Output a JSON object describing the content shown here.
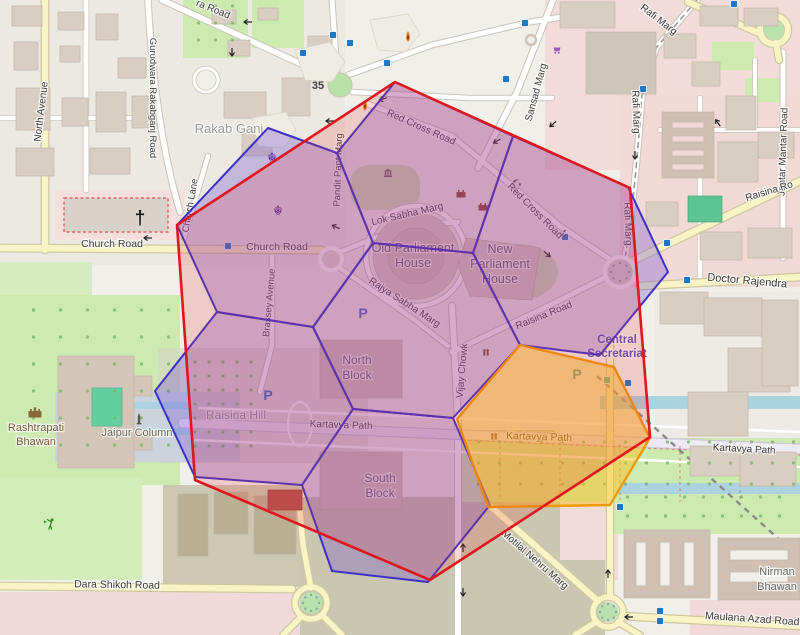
{
  "overlays": {
    "red_hexagon": {
      "stroke": "#e0161f",
      "fill": "rgba(230,60,60,0.20)",
      "stroke_width": 2.6,
      "points": [
        [
          395,
          82
        ],
        [
          630,
          188
        ],
        [
          650,
          437
        ],
        [
          430,
          580
        ],
        [
          195,
          480
        ],
        [
          177,
          225
        ]
      ]
    },
    "blue_hexagons": {
      "stroke": "#3c30c8",
      "fill": "rgba(105,70,205,0.30)",
      "stroke_width": 2,
      "cells": [
        [
          [
            373,
            243
          ],
          [
            337,
            153
          ],
          [
            395,
            82
          ],
          [
            513,
            136
          ],
          [
            473,
            253
          ]
        ],
        [
          [
            473,
            253
          ],
          [
            513,
            136
          ],
          [
            628,
            187
          ],
          [
            668,
            272
          ],
          [
            600,
            355
          ],
          [
            520,
            345
          ]
        ],
        [
          [
            373,
            243
          ],
          [
            473,
            253
          ],
          [
            520,
            345
          ],
          [
            453,
            418
          ],
          [
            353,
            409
          ],
          [
            313,
            327
          ]
        ],
        [
          [
            337,
            153
          ],
          [
            268,
            128
          ],
          [
            177,
            225
          ],
          [
            217,
            312
          ],
          [
            313,
            327
          ],
          [
            373,
            243
          ]
        ],
        [
          [
            313,
            327
          ],
          [
            217,
            312
          ],
          [
            155,
            391
          ],
          [
            195,
            477
          ],
          [
            302,
            485
          ],
          [
            353,
            409
          ]
        ],
        [
          [
            353,
            409
          ],
          [
            302,
            485
          ],
          [
            332,
            571
          ],
          [
            428,
            582
          ],
          [
            490,
            505
          ],
          [
            453,
            418
          ]
        ]
      ]
    },
    "yellow_hexagon": {
      "stroke": "#ee9a00",
      "fill": "rgba(250,192,35,0.50)",
      "stroke_width": 2.4,
      "points": [
        [
          520,
          345
        ],
        [
          614,
          367
        ],
        [
          650,
          438
        ],
        [
          610,
          505
        ],
        [
          488,
          507
        ],
        [
          457,
          419
        ]
      ]
    }
  },
  "labels": [
    {
      "name": "road-label",
      "t": "North Avenue",
      "x": 44,
      "y": 112,
      "r": -83,
      "fs": 10
    },
    {
      "name": "road-label",
      "t": "Gurudwara Rakabganj Road",
      "x": 150,
      "y": 98,
      "r": 90,
      "fs": 9.5
    },
    {
      "name": "road-label",
      "t": "ra Road",
      "x": 212,
      "y": 12,
      "r": 22,
      "fs": 10
    },
    {
      "name": "place-label",
      "t": "Rakab Ganj",
      "x": 229,
      "y": 133,
      "r": 0,
      "fs": 13,
      "c": "#9c9c9c"
    },
    {
      "name": "road-label",
      "t": "Rafi Marg",
      "x": 657,
      "y": 22,
      "r": 38,
      "fs": 10
    },
    {
      "name": "road-label",
      "t": "Rafi Marg",
      "x": 633,
      "y": 112,
      "r": 88,
      "fs": 10
    },
    {
      "name": "road-label",
      "t": "Rafi Marg",
      "x": 625,
      "y": 224,
      "r": 88,
      "fs": 10
    },
    {
      "name": "road-label",
      "t": "Sansad Marg",
      "x": 539,
      "y": 93,
      "r": -75,
      "fs": 10
    },
    {
      "name": "road-label",
      "t": "Jantar Mantar Road",
      "x": 786,
      "y": 152,
      "r": -88,
      "fs": 10
    },
    {
      "name": "road-label",
      "t": "Raisina Ro",
      "x": 770,
      "y": 194,
      "r": -17,
      "fs": 10
    },
    {
      "name": "road-label",
      "t": "Doctor Rajendra",
      "x": 747,
      "y": 284,
      "r": 5,
      "fs": 11
    },
    {
      "name": "road-label",
      "t": "Red Cross Road",
      "x": 420,
      "y": 130,
      "r": 24,
      "fs": 10
    },
    {
      "name": "road-label",
      "t": "Red Cross Road",
      "x": 533,
      "y": 213,
      "r": 45,
      "fs": 10
    },
    {
      "name": "road-label",
      "t": "Church Road",
      "x": 112,
      "y": 247,
      "r": 0,
      "fs": 10.5
    },
    {
      "name": "road-label",
      "t": "Church Road",
      "x": 277,
      "y": 250,
      "r": 0,
      "fs": 10.5
    },
    {
      "name": "road-label",
      "t": "Church Lane",
      "x": 193,
      "y": 206,
      "r": -80,
      "fs": 9.5
    },
    {
      "name": "road-label",
      "t": "Pandit Pant Marg",
      "x": 341,
      "y": 170,
      "r": -88,
      "fs": 9.5
    },
    {
      "name": "road-label",
      "t": "Brassey Avenue",
      "x": 272,
      "y": 303,
      "r": -85,
      "fs": 9.5
    },
    {
      "name": "road-label",
      "t": "Lok Sabha Marg",
      "x": 408,
      "y": 217,
      "r": -13,
      "fs": 10
    },
    {
      "name": "road-label",
      "t": "Rajya Sabha Marg",
      "x": 403,
      "y": 305,
      "r": 33,
      "fs": 10
    },
    {
      "name": "road-label",
      "t": "Raisina Road",
      "x": 545,
      "y": 318,
      "r": -22,
      "fs": 10
    },
    {
      "name": "place-label",
      "t": "Raisina Hill",
      "x": 236,
      "y": 419,
      "r": 0,
      "fs": 12,
      "c": "#8b8b96"
    },
    {
      "name": "building-label",
      "t": "Old Parliament",
      "x": 413,
      "y": 252,
      "r": 0,
      "fs": 12.5,
      "c": "#5d5763"
    },
    {
      "name": "building-label",
      "t": "House",
      "x": 413,
      "y": 267,
      "r": 0,
      "fs": 12.5,
      "c": "#5d5763"
    },
    {
      "name": "building-label",
      "t": "New",
      "x": 500,
      "y": 253,
      "r": 0,
      "fs": 12.5,
      "c": "#5d5763"
    },
    {
      "name": "building-label",
      "t": "Parliament",
      "x": 500,
      "y": 268,
      "r": 0,
      "fs": 12.5,
      "c": "#5d5763"
    },
    {
      "name": "building-label",
      "t": "House",
      "x": 500,
      "y": 283,
      "r": 0,
      "fs": 12.5,
      "c": "#5d5763"
    },
    {
      "name": "building-label",
      "t": "North",
      "x": 357,
      "y": 364,
      "r": 0,
      "fs": 12,
      "c": "#5d5763"
    },
    {
      "name": "building-label",
      "t": "Block",
      "x": 357,
      "y": 379,
      "r": 0,
      "fs": 12,
      "c": "#5d5763"
    },
    {
      "name": "building-label",
      "t": "South",
      "x": 380,
      "y": 482,
      "r": 0,
      "fs": 12,
      "c": "#5d5763"
    },
    {
      "name": "building-label",
      "t": "Block",
      "x": 380,
      "y": 497,
      "r": 0,
      "fs": 12,
      "c": "#5d5763"
    },
    {
      "name": "road-label",
      "t": "Kartavya Path",
      "x": 341,
      "y": 428,
      "r": 2,
      "fs": 10
    },
    {
      "name": "road-label",
      "t": "Kartavya Path",
      "x": 539,
      "y": 440,
      "r": 2,
      "fs": 10.5,
      "c": "#4a3a14"
    },
    {
      "name": "road-label",
      "t": "Kartavya Path",
      "x": 744,
      "y": 452,
      "r": 3,
      "fs": 10
    },
    {
      "name": "road-label",
      "t": "Vijay Chowk",
      "x": 465,
      "y": 371,
      "r": -85,
      "fs": 10
    },
    {
      "name": "amenity-label",
      "t": "Rashtrapati",
      "x": 36,
      "y": 431,
      "r": 0,
      "fs": 11,
      "c": "#7a5b38"
    },
    {
      "name": "amenity-label",
      "t": "Bhawan",
      "x": 36,
      "y": 445,
      "r": 0,
      "fs": 11,
      "c": "#7a5b38"
    },
    {
      "name": "amenity-label",
      "t": "Jaipur Column",
      "x": 137,
      "y": 436,
      "r": 0,
      "fs": 11,
      "c": "#6b6550"
    },
    {
      "name": "station-label",
      "t": "Central",
      "x": 617,
      "y": 343,
      "r": 0,
      "fs": 11.5,
      "c": "#5151bb",
      "b": true
    },
    {
      "name": "station-label",
      "t": "Secretariat",
      "x": 617,
      "y": 357,
      "r": 0,
      "fs": 11.5,
      "c": "#5151bb",
      "b": true
    },
    {
      "name": "road-label",
      "t": "Motilal Nehru Marg",
      "x": 533,
      "y": 562,
      "r": 41,
      "fs": 10
    },
    {
      "name": "road-label",
      "t": "Dara Shikoh Road",
      "x": 117,
      "y": 588,
      "r": 1,
      "fs": 10.5
    },
    {
      "name": "road-label",
      "t": "Maulana Azad Road",
      "x": 752,
      "y": 622,
      "r": 4,
      "fs": 10.5
    },
    {
      "name": "building-label",
      "t": "Nirman",
      "x": 777,
      "y": 575,
      "r": 0,
      "fs": 11,
      "c": "#6a6a6a"
    },
    {
      "name": "building-label",
      "t": "Bhawan",
      "x": 777,
      "y": 590,
      "r": 0,
      "fs": 11,
      "c": "#6a6a6a"
    }
  ],
  "glyph_icons": [
    {
      "name": "gurudwara-khanda-icon",
      "glyph": "☬",
      "x": 272,
      "y": 162,
      "fs": 13,
      "c": "#55258f"
    },
    {
      "name": "gurudwara-khanda-icon",
      "glyph": "☬",
      "x": 278,
      "y": 215,
      "fs": 13,
      "c": "#55258f"
    },
    {
      "name": "church-cross-icon",
      "glyph": "†",
      "x": 140,
      "y": 224,
      "fs": 19,
      "c": "#1d1d1d",
      "b": true
    },
    {
      "name": "mosque-crescent-icon",
      "glyph": "☪",
      "x": 517,
      "y": 189,
      "fs": 13,
      "c": "#3d3746"
    },
    {
      "name": "hindu-temple-om-icon",
      "glyph": "35",
      "x": 318,
      "y": 89,
      "fs": 11,
      "c": "#3f3f3f",
      "b": true
    }
  ],
  "parking_icons": [
    {
      "x": 268,
      "y": 400,
      "c": "#2f6fc4"
    },
    {
      "x": 363,
      "y": 318,
      "c": "#4a63c8"
    },
    {
      "x": 577,
      "y": 379,
      "c": "#2f8fa0"
    }
  ],
  "traffic_signals": [
    [
      333,
      35
    ],
    [
      350,
      43
    ],
    [
      303,
      53
    ],
    [
      387,
      63
    ],
    [
      506,
      79
    ],
    [
      734,
      4
    ],
    [
      643,
      89
    ],
    [
      565,
      237
    ],
    [
      667,
      243
    ],
    [
      687,
      280
    ],
    [
      228,
      246
    ],
    [
      628,
      383
    ],
    [
      620,
      507
    ],
    [
      660,
      611
    ],
    [
      660,
      621
    ],
    [
      525,
      23
    ]
  ],
  "transit_squares": [
    [
      607,
      380
    ]
  ],
  "oneway_arrows": [
    [
      248,
      22,
      180
    ],
    [
      232,
      52,
      90
    ],
    [
      330,
      121,
      180
    ],
    [
      383,
      99,
      160
    ],
    [
      553,
      124,
      140
    ],
    [
      497,
      141,
      150
    ],
    [
      336,
      227,
      205
    ],
    [
      547,
      254,
      40
    ],
    [
      563,
      233,
      130
    ],
    [
      148,
      238,
      180
    ],
    [
      635,
      155,
      90
    ],
    [
      463,
      548,
      270
    ],
    [
      463,
      592,
      90
    ],
    [
      608,
      574,
      270
    ],
    [
      629,
      617,
      180
    ],
    [
      718,
      123,
      235
    ]
  ],
  "shape_icons": [
    {
      "type": "flame",
      "x": 408,
      "y": 37
    },
    {
      "type": "flame",
      "x": 365,
      "y": 106
    },
    {
      "type": "fort",
      "x": 461,
      "y": 194
    },
    {
      "type": "fort",
      "x": 483,
      "y": 207
    },
    {
      "type": "museum",
      "x": 388,
      "y": 174
    },
    {
      "type": "cart",
      "x": 557,
      "y": 50
    },
    {
      "type": "castle",
      "x": 35,
      "y": 413
    },
    {
      "type": "column",
      "x": 139,
      "y": 419
    },
    {
      "type": "golfer",
      "x": 50,
      "y": 525
    },
    {
      "type": "people",
      "x": 494,
      "y": 437
    },
    {
      "type": "people",
      "x": 486,
      "y": 353
    }
  ],
  "decor": {
    "tree_areas": [
      {
        "x": 188,
        "y": 362,
        "w": 66,
        "h": 98,
        "step": 14
      },
      {
        "x": 20,
        "y": 310,
        "w": 150,
        "h": 160,
        "step": 27
      },
      {
        "x": 468,
        "y": 442,
        "w": 326,
        "h": 54,
        "step": 21
      },
      {
        "x": 618,
        "y": 497,
        "w": 175,
        "h": 32,
        "step": 19
      },
      {
        "x": 190,
        "y": 6,
        "w": 52,
        "h": 46,
        "step": 17
      }
    ],
    "dotted_circles": [
      [
        620,
        272,
        9
      ],
      [
        311,
        603,
        8
      ],
      [
        608,
        612,
        8
      ]
    ]
  }
}
